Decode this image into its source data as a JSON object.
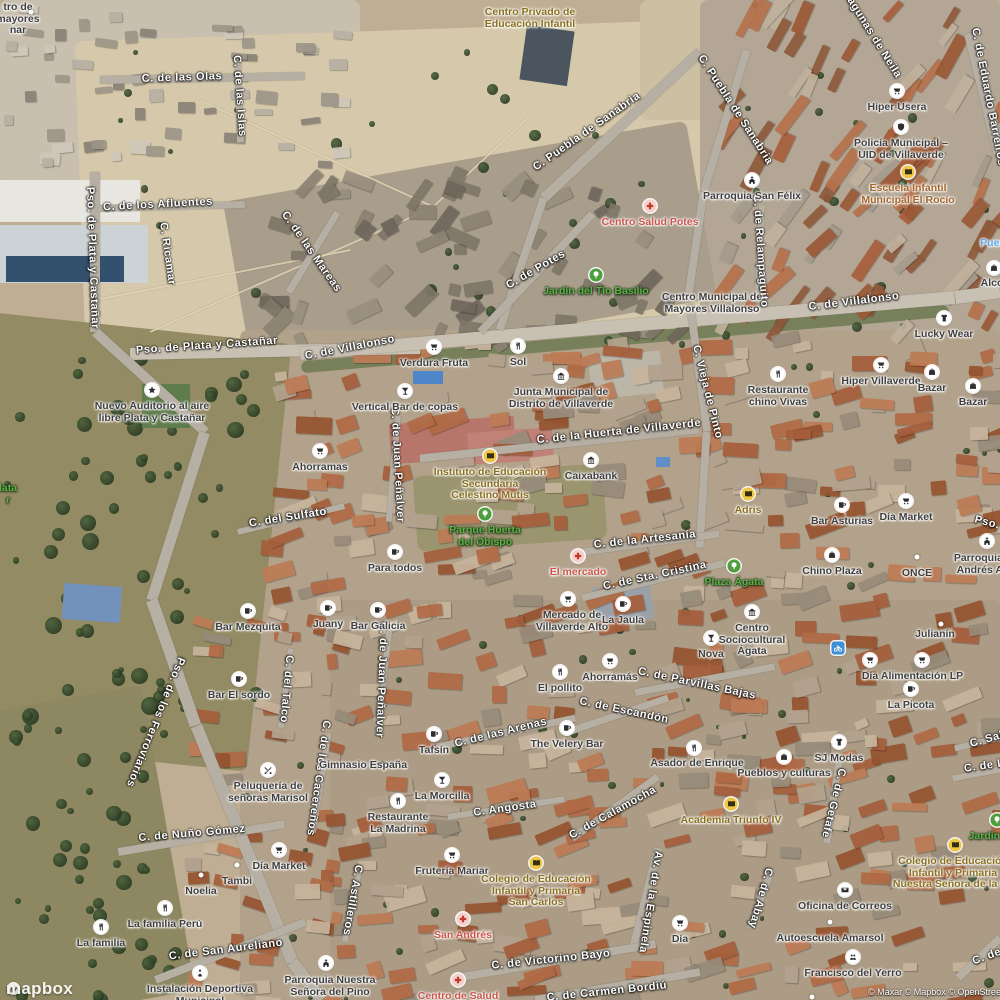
{
  "attribution": {
    "brand": "mapbox",
    "credits": "© Maxar © Mapbox © OpenStreetMap"
  },
  "colors": {
    "street_text": "#ffffff",
    "poi_text": "#3f3f3f",
    "medical_text": "#c9544a",
    "park_text": "#5ab446",
    "education_text": "#8a701e",
    "transit_text": "#57a8e8",
    "education_icon_bg": "#f0c543",
    "park_icon_bg": "#4d9e3f",
    "medical_icon_bg": "#f6d0cb",
    "bike_icon_bg": "#3f8fd6",
    "poi_icon_bg": "#ffffff"
  },
  "street_labels": [
    {
      "text": "C. de las Olas",
      "x": 182,
      "y": 78,
      "rot": -2
    },
    {
      "text": "C. de las Islas",
      "x": 239,
      "y": 96,
      "rot": 86
    },
    {
      "text": "C. Puebla de Sanabria",
      "x": 587,
      "y": 132,
      "rot": -35
    },
    {
      "text": "C. Puebla de Sanabria",
      "x": 735,
      "y": 110,
      "rot": 57
    },
    {
      "text": "Lagunas de Neila",
      "x": 872,
      "y": 35,
      "rot": 58
    },
    {
      "text": "C. de Eduardo Barreiros",
      "x": 988,
      "y": 97,
      "rot": 79
    },
    {
      "text": "C. de los Afluentes",
      "x": 158,
      "y": 205,
      "rot": -3
    },
    {
      "text": "Pso. de Plata y Castañar",
      "x": 92,
      "y": 258,
      "rot": 88
    },
    {
      "text": "C. Ricamar",
      "x": 167,
      "y": 254,
      "rot": 82
    },
    {
      "text": "C. de las Mareas",
      "x": 311,
      "y": 252,
      "rot": 55
    },
    {
      "text": "C. de Relampaguito",
      "x": 760,
      "y": 251,
      "rot": 86
    },
    {
      "text": "Pso. de Plata y Castañar",
      "x": 207,
      "y": 346,
      "rot": -4
    },
    {
      "text": "C. de Villalonso",
      "x": 350,
      "y": 348,
      "rot": -11
    },
    {
      "text": "C. de Villalonso",
      "x": 854,
      "y": 302,
      "rot": -7
    },
    {
      "text": "C. de Potes",
      "x": 536,
      "y": 270,
      "rot": -30
    },
    {
      "text": "C. de la Huerta de Villaverde",
      "x": 619,
      "y": 432,
      "rot": -6
    },
    {
      "text": "C. Vieja de Pinto",
      "x": 707,
      "y": 392,
      "rot": 76
    },
    {
      "text": "C. de Juan Peñalver",
      "x": 397,
      "y": 465,
      "rot": 87
    },
    {
      "text": "C. del Sulfato",
      "x": 288,
      "y": 518,
      "rot": -9
    },
    {
      "text": "C. de la Artesanía",
      "x": 645,
      "y": 540,
      "rot": -6
    },
    {
      "text": "C. de Sta. Cristina",
      "x": 655,
      "y": 576,
      "rot": -12
    },
    {
      "text": "Pso.",
      "x": 987,
      "y": 523,
      "rot": 15
    },
    {
      "text": "C. de Juan Peñalver",
      "x": 381,
      "y": 680,
      "rot": 92
    },
    {
      "text": "Pso. de los Ferroviarios",
      "x": 155,
      "y": 722,
      "rot": 112
    },
    {
      "text": "C. del Talco",
      "x": 286,
      "y": 689,
      "rot": 95
    },
    {
      "text": "C. de Parvillas Bajas",
      "x": 697,
      "y": 684,
      "rot": 12
    },
    {
      "text": "C. de Escandón",
      "x": 624,
      "y": 711,
      "rot": 12
    },
    {
      "text": "C. de las Arenas",
      "x": 501,
      "y": 733,
      "rot": -14
    },
    {
      "text": "C. de los Cacereños",
      "x": 318,
      "y": 778,
      "rot": 98
    },
    {
      "text": "C. de Nuño Gómez",
      "x": 192,
      "y": 834,
      "rot": -5
    },
    {
      "text": "C. Angosta",
      "x": 505,
      "y": 809,
      "rot": -8
    },
    {
      "text": "C. de Calamocha",
      "x": 613,
      "y": 813,
      "rot": -29
    },
    {
      "text": "Av. de la Espinela",
      "x": 650,
      "y": 902,
      "rot": 99
    },
    {
      "text": "C. Astilleros",
      "x": 352,
      "y": 900,
      "rot": 100
    },
    {
      "text": "C. de Abay",
      "x": 760,
      "y": 898,
      "rot": 106
    },
    {
      "text": "C. de Getafe",
      "x": 833,
      "y": 803,
      "rot": 104
    },
    {
      "text": "C. Sals",
      "x": 990,
      "y": 739,
      "rot": -16
    },
    {
      "text": "C. de Lu",
      "x": 988,
      "y": 766,
      "rot": -8
    },
    {
      "text": "C. de Victorino Bayo",
      "x": 551,
      "y": 960,
      "rot": -6
    },
    {
      "text": "C. de San Aureliano",
      "x": 226,
      "y": 950,
      "rot": -7
    },
    {
      "text": "C. de Carmen Bordiú",
      "x": 607,
      "y": 992,
      "rot": -6
    },
    {
      "text": "C. de",
      "x": 987,
      "y": 957,
      "rot": -20
    }
  ],
  "poi_labels": [
    {
      "lines": [
        "tro de",
        "mayores",
        "nar"
      ],
      "x": 18,
      "y": 7,
      "cat": "poi"
    },
    {
      "lines": [
        "Centro Privado de",
        "Educación Infantil"
      ],
      "x": 530,
      "y": 12,
      "cat": "education"
    },
    {
      "lines": [
        "Hiper Usera"
      ],
      "x": 897,
      "y": 107,
      "cat": "poi",
      "icon": "shopping-cart-icon"
    },
    {
      "lines": [
        "Policía Municipal –",
        "UID de Villaverde"
      ],
      "x": 901,
      "y": 143,
      "cat": "poi",
      "icon": "police-shield-icon"
    },
    {
      "lines": [
        "Escuela Infantil",
        "Municipal El Rocío"
      ],
      "x": 908,
      "y": 188,
      "cat": "education",
      "color": "#a4652a",
      "icon": "school-icon"
    },
    {
      "lines": [
        "Parroquia San Félix"
      ],
      "x": 752,
      "y": 196,
      "cat": "poi",
      "icon": "church-icon"
    },
    {
      "lines": [
        "Centro Salud Potes"
      ],
      "x": 650,
      "y": 222,
      "cat": "medical",
      "icon": "medical-cross-icon"
    },
    {
      "lines": [
        "Jardín del Tío Basilio"
      ],
      "x": 596,
      "y": 291,
      "cat": "park",
      "icon": "park-tree-icon"
    },
    {
      "lines": [
        "Centro Municipal de",
        "Mayores Villalonso"
      ],
      "x": 712,
      "y": 297,
      "cat": "poi"
    },
    {
      "lines": [
        "Lucky Wear"
      ],
      "x": 944,
      "y": 334,
      "cat": "poi",
      "icon": "clothing-icon"
    },
    {
      "lines": [
        "Puen"
      ],
      "x": 993,
      "y": 243,
      "cat": "transit"
    },
    {
      "lines": [
        "Alco"
      ],
      "x": 992,
      "y": 283,
      "cat": "poi",
      "icon": "shopping-bag-icon",
      "icon_x": 994,
      "icon_y": 268
    },
    {
      "lines": [
        "Hiper Villaverde"
      ],
      "x": 881,
      "y": 381,
      "cat": "poi",
      "icon": "shopping-cart-icon"
    },
    {
      "lines": [
        "Restaurante",
        "chino Vivas"
      ],
      "x": 778,
      "y": 390,
      "cat": "poi",
      "icon": "restaurant-icon"
    },
    {
      "lines": [
        "Bazar"
      ],
      "x": 932,
      "y": 388,
      "cat": "poi",
      "icon": "shopping-bag-icon"
    },
    {
      "lines": [
        "Bazar"
      ],
      "x": 973,
      "y": 402,
      "cat": "poi",
      "icon": "shopping-bag-icon"
    },
    {
      "lines": [
        "Verdura Fruta"
      ],
      "x": 434,
      "y": 363,
      "cat": "poi",
      "icon": "shopping-cart-icon"
    },
    {
      "lines": [
        "Sol"
      ],
      "x": 518,
      "y": 362,
      "cat": "poi",
      "icon": "restaurant-icon"
    },
    {
      "lines": [
        "Junta Municipal de",
        "Distrito de Villaverde"
      ],
      "x": 561,
      "y": 392,
      "cat": "poi",
      "icon": "town-hall-icon"
    },
    {
      "lines": [
        "Vertical Bar de copas"
      ],
      "x": 405,
      "y": 407,
      "cat": "poi",
      "icon": "cocktail-icon"
    },
    {
      "lines": [
        "Ahorramas"
      ],
      "x": 320,
      "y": 467,
      "cat": "poi",
      "icon": "shopping-cart-icon"
    },
    {
      "lines": [
        "Instituto de Educación",
        "Secundaria",
        "Celestino Mutis"
      ],
      "x": 490,
      "y": 472,
      "cat": "education",
      "icon": "school-icon"
    },
    {
      "lines": [
        "Caixabank"
      ],
      "x": 591,
      "y": 476,
      "cat": "poi",
      "icon": "bank-icon"
    },
    {
      "lines": [
        "Parque Huerta",
        "del Obispo"
      ],
      "x": 485,
      "y": 530,
      "cat": "park",
      "icon": "park-tree-icon"
    },
    {
      "lines": [
        "Adris"
      ],
      "x": 748,
      "y": 510,
      "cat": "education",
      "icon": "school-icon"
    },
    {
      "lines": [
        "Bar Asturias"
      ],
      "x": 842,
      "y": 521,
      "cat": "poi",
      "icon": "bar-mug-icon"
    },
    {
      "lines": [
        "Día Market"
      ],
      "x": 906,
      "y": 517,
      "cat": "poi",
      "icon": "shopping-cart-icon"
    },
    {
      "lines": [
        "El mercado"
      ],
      "x": 578,
      "y": 572,
      "cat": "medical",
      "icon": "medical-cross-icon"
    },
    {
      "lines": [
        "Mercado de",
        "Villaverde Alto"
      ],
      "x": 572,
      "y": 615,
      "cat": "poi",
      "icon": "shopping-cart-icon",
      "icon_x": 568,
      "icon_y": 599
    },
    {
      "lines": [
        "La Jaula"
      ],
      "x": 623,
      "y": 620,
      "cat": "poi",
      "icon": "bar-mug-icon"
    },
    {
      "lines": [
        "Plaza Ágata"
      ],
      "x": 734,
      "y": 582,
      "cat": "park",
      "icon": "park-tree-icon"
    },
    {
      "lines": [
        "Chino Plaza"
      ],
      "x": 832,
      "y": 571,
      "cat": "poi",
      "icon": "shopping-bag-icon"
    },
    {
      "lines": [
        "ONCE"
      ],
      "x": 917,
      "y": 573,
      "cat": "poi",
      "icon": "poi-dot-icon"
    },
    {
      "lines": [
        "Parroquia d",
        "Andrés Ap"
      ],
      "x": 983,
      "y": 558,
      "cat": "poi",
      "icon": "church-icon",
      "icon_x": 987,
      "icon_y": 541
    },
    {
      "lines": [
        "Para todos"
      ],
      "x": 395,
      "y": 568,
      "cat": "poi",
      "icon": "bar-mug-icon"
    },
    {
      "lines": [
        "Bar Galicia"
      ],
      "x": 378,
      "y": 626,
      "cat": "poi",
      "icon": "bar-mug-icon"
    },
    {
      "lines": [
        "Bar Mezquita"
      ],
      "x": 248,
      "y": 627,
      "cat": "poi",
      "icon": "bar-mug-icon"
    },
    {
      "lines": [
        "Juany"
      ],
      "x": 328,
      "y": 624,
      "cat": "poi",
      "icon": "bar-mug-icon"
    },
    {
      "lines": [
        "Bar El sordo"
      ],
      "x": 239,
      "y": 695,
      "cat": "poi",
      "icon": "bar-mug-icon"
    },
    {
      "lines": [
        "Centro",
        "Sociocultural",
        "Ágata"
      ],
      "x": 752,
      "y": 628,
      "cat": "poi",
      "icon": "town-hall-icon"
    },
    {
      "lines": [
        "Nova"
      ],
      "x": 711,
      "y": 654,
      "cat": "poi",
      "icon": "cocktail-icon"
    },
    {
      "lines": [
        "Ahorramás"
      ],
      "x": 610,
      "y": 677,
      "cat": "poi",
      "icon": "shopping-cart-icon"
    },
    {
      "lines": [
        "El pollito"
      ],
      "x": 560,
      "y": 688,
      "cat": "poi",
      "icon": "restaurant-icon"
    },
    {
      "lines": [
        "Día"
      ],
      "x": 870,
      "y": 676,
      "cat": "poi",
      "icon": "shopping-cart-icon"
    },
    {
      "lines": [
        "Alimentación LP"
      ],
      "x": 922,
      "y": 676,
      "cat": "poi",
      "icon": "shopping-cart-icon"
    },
    {
      "lines": [
        "Julianín"
      ],
      "x": 935,
      "y": 634,
      "cat": "poi",
      "icon": "poi-dot-icon",
      "icon_x": 941,
      "icon_y": 624
    },
    {
      "lines": [
        "La Picota"
      ],
      "x": 911,
      "y": 705,
      "cat": "poi",
      "icon": "bar-mug-icon"
    },
    {
      "lines": [],
      "x": 838,
      "y": 648,
      "cat": "bike",
      "icon": "bicycle-icon",
      "icon_x": 838,
      "icon_y": 648
    },
    {
      "lines": [
        "Tafsín"
      ],
      "x": 434,
      "y": 750,
      "cat": "poi",
      "icon": "bar-mug-icon"
    },
    {
      "lines": [
        "The Velery Bar"
      ],
      "x": 567,
      "y": 744,
      "cat": "poi",
      "icon": "bar-mug-icon"
    },
    {
      "lines": [
        "Asador de Enrique"
      ],
      "x": 697,
      "y": 763,
      "cat": "poi",
      "icon": "restaurant-icon",
      "icon_x": 694,
      "icon_y": 748
    },
    {
      "lines": [
        "Gimnasio España"
      ],
      "x": 363,
      "y": 765,
      "cat": "poi"
    },
    {
      "lines": [
        "Pueblos y culturas"
      ],
      "x": 784,
      "y": 773,
      "cat": "poi",
      "icon": "shopping-bag-icon"
    },
    {
      "lines": [
        "SJ Modas"
      ],
      "x": 839,
      "y": 758,
      "cat": "poi",
      "icon": "clothing-icon"
    },
    {
      "lines": [
        "Peluquería de",
        "señoras Marisol"
      ],
      "x": 268,
      "y": 786,
      "cat": "poi",
      "icon": "hairdresser-icon"
    },
    {
      "lines": [
        "La Morcilla"
      ],
      "x": 442,
      "y": 796,
      "cat": "poi",
      "icon": "cocktail-icon"
    },
    {
      "lines": [
        "Restaurante",
        "La Madrina"
      ],
      "x": 398,
      "y": 817,
      "cat": "poi",
      "icon": "restaurant-icon"
    },
    {
      "lines": [
        "Academia Triunfo IV"
      ],
      "x": 731,
      "y": 820,
      "cat": "education",
      "icon": "school-icon"
    },
    {
      "lines": [
        "Frutería Mariar"
      ],
      "x": 452,
      "y": 871,
      "cat": "poi",
      "icon": "shopping-cart-icon"
    },
    {
      "lines": [
        "Colegio de Educación",
        "Infantil y Primaria",
        "San Carlos"
      ],
      "x": 536,
      "y": 879,
      "cat": "education",
      "icon": "school-icon"
    },
    {
      "lines": [
        "Colegio de Educación",
        "Infantil y Primaria",
        "Nuestra Señora de la Lu"
      ],
      "x": 953,
      "y": 861,
      "cat": "education",
      "icon": "school-icon",
      "icon_x": 955,
      "icon_y": 845
    },
    {
      "lines": [
        "Jardín d"
      ],
      "x": 989,
      "y": 836,
      "cat": "park",
      "icon": "park-tree-icon",
      "icon_x": 997,
      "icon_y": 820
    },
    {
      "lines": [
        "Oficina de Correos"
      ],
      "x": 845,
      "y": 906,
      "cat": "poi",
      "icon": "post-envelope-icon"
    },
    {
      "lines": [
        "Autoescuela Amarsol"
      ],
      "x": 830,
      "y": 938,
      "cat": "poi",
      "icon": "poi-dot-icon"
    },
    {
      "lines": [
        "Francisco del Yerro"
      ],
      "x": 853,
      "y": 973,
      "cat": "poi",
      "icon": "people-icon"
    },
    {
      "lines": [
        "San Andrés"
      ],
      "x": 463,
      "y": 935,
      "cat": "medical",
      "icon": "medical-cross-icon"
    },
    {
      "lines": [
        "Centro de Salud"
      ],
      "x": 458,
      "y": 996,
      "cat": "medical",
      "icon": "medical-cross-icon"
    },
    {
      "lines": [
        "La familia Perú"
      ],
      "x": 165,
      "y": 924,
      "cat": "poi",
      "icon": "restaurant-icon"
    },
    {
      "lines": [
        "La familia"
      ],
      "x": 101,
      "y": 943,
      "cat": "poi",
      "icon": "restaurant-icon"
    },
    {
      "lines": [
        "Tambi"
      ],
      "x": 237,
      "y": 881,
      "cat": "poi",
      "icon": "poi-dot-icon"
    },
    {
      "lines": [
        "Noelia"
      ],
      "x": 201,
      "y": 891,
      "cat": "poi",
      "icon": "poi-dot-icon"
    },
    {
      "lines": [
        "Día Market"
      ],
      "x": 279,
      "y": 866,
      "cat": "poi",
      "icon": "shopping-cart-icon"
    },
    {
      "lines": [
        "Instalación Deportiva",
        "Municipal"
      ],
      "x": 200,
      "y": 989,
      "cat": "poi",
      "icon": "sports-icon"
    },
    {
      "lines": [
        "Parroquia Nuestra",
        "Señora del Pino"
      ],
      "x": 330,
      "y": 980,
      "cat": "poi",
      "icon": "church-icon",
      "icon_x": 326,
      "icon_y": 963
    },
    {
      "lines": [
        "Nuevo Auditorio al aire",
        "libre Plata y Castañar"
      ],
      "x": 152,
      "y": 406,
      "cat": "poi",
      "icon": "attraction-icon"
    },
    {
      "lines": [
        "lata",
        "r"
      ],
      "x": 8,
      "y": 488,
      "cat": "park"
    },
    {
      "lines": [
        "Día"
      ],
      "x": 680,
      "y": 939,
      "cat": "poi",
      "icon": "shopping-cart-icon"
    },
    {
      "lines": [],
      "x": 31,
      "y": 12,
      "cat": "poi",
      "icon": "poi-dot-icon",
      "icon_x": 31,
      "icon_y": 12
    },
    {
      "lines": [],
      "x": 812,
      "y": 997,
      "cat": "poi",
      "icon": "poi-dot-icon",
      "icon_x": 812,
      "icon_y": 997
    }
  ]
}
